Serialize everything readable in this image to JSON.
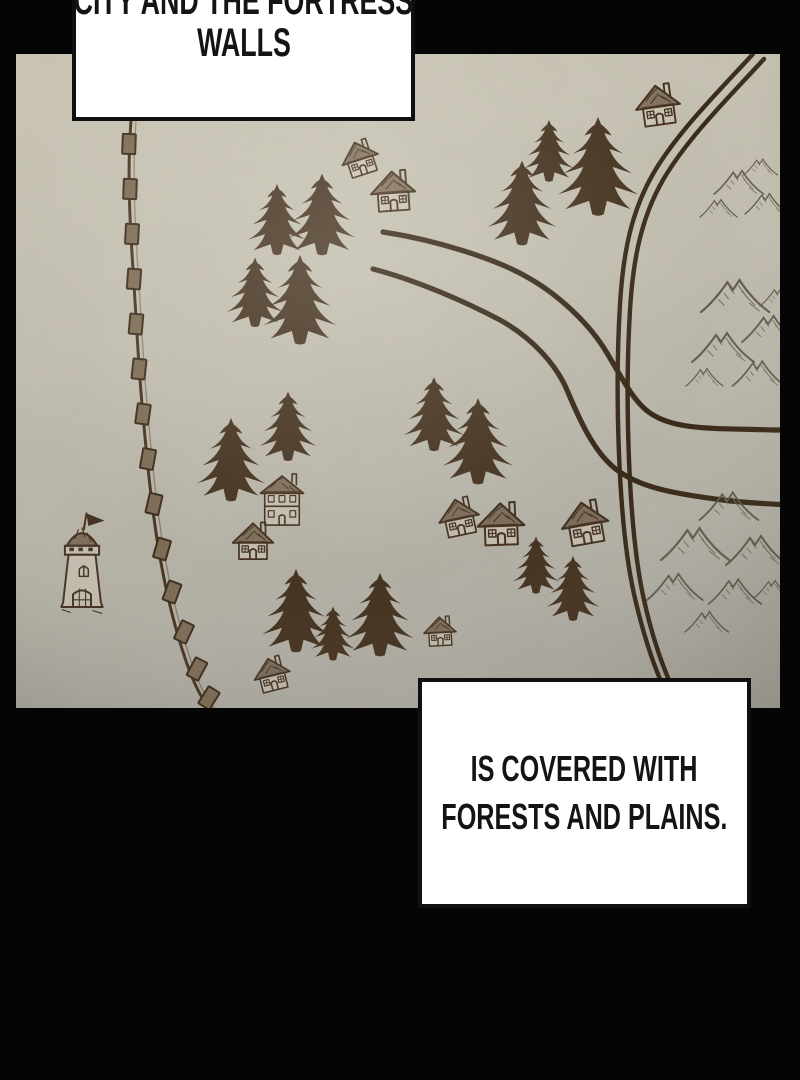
{
  "panel": {
    "background_color": "#000000"
  },
  "captions": {
    "top": {
      "line1": "CITY AND THE FORTRESS",
      "line2": "WALLS"
    },
    "bottom": {
      "line1": "IS COVERED WITH",
      "line2": "FORESTS AND PLAINS."
    }
  },
  "map": {
    "style": "hand-drawn parchment map",
    "colors": {
      "parchment": "#c6c1b2",
      "ink": "#43301f",
      "mountain": "#5d564a",
      "caption_background": "#ffffff",
      "caption_border": "#101010",
      "caption_text": "#141414"
    },
    "features": {
      "fortress_wall": "crenellated wall along the west side",
      "watchtower": "flagged watchtower inside the walls",
      "pine_trees": 16,
      "cottages": 9,
      "two_story_houses": 1,
      "roads": 2,
      "mountain_ranges": 3
    }
  }
}
